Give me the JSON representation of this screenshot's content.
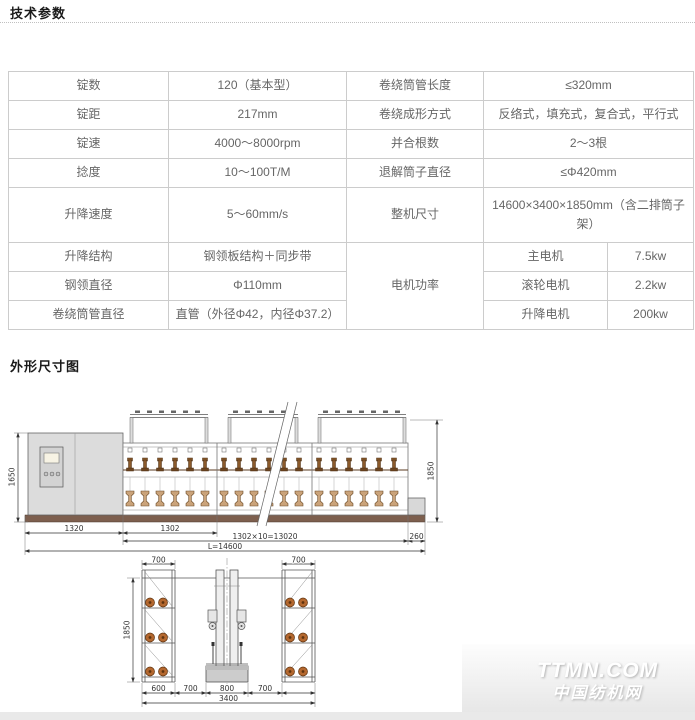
{
  "header": {
    "section1_title": "技术参数",
    "section2_title": "外形尺寸图"
  },
  "specs_table": {
    "rows": [
      {
        "l_label": "锭数",
        "l_value": "120（基本型）",
        "r_label": "卷绕筒管长度",
        "r_value": "≤320mm"
      },
      {
        "l_label": "锭距",
        "l_value": "217mm",
        "r_label": "卷绕成形方式",
        "r_value": "反络式，填充式，复合式，平行式"
      },
      {
        "l_label": "锭速",
        "l_value": "4000～8000rpm",
        "r_label": "并合根数",
        "r_value": "2～3根"
      },
      {
        "l_label": "捻度",
        "l_value": "10～100T/M",
        "r_label": "退解筒子直径",
        "r_value": "≤Φ420mm"
      },
      {
        "l_label": "升降速度",
        "l_value": "5～60mm/s",
        "r_label": "整机尺寸",
        "r_value": "14600×3400×1850mm（含二排筒子架）"
      }
    ],
    "motor_group_label": "电机功率",
    "motor_rows": [
      {
        "l_label": "升降结构",
        "l_value": "钢领板结构＋同步带",
        "m_label": "主电机",
        "m_value": "7.5kw"
      },
      {
        "l_label": "钢领直径",
        "l_value": "Φ110mm",
        "m_label": "滚轮电机",
        "m_value": "2.2kw"
      },
      {
        "l_label": "卷绕筒管直径",
        "l_value": "直管（外径Φ42，内径Φ37.2）",
        "m_label": "升降电机",
        "m_value": "200kw"
      }
    ]
  },
  "side_view": {
    "height_left": "1650",
    "height_right": "1850",
    "dim_cabinet": "1320",
    "dim_section": "1302",
    "dim_sections_total": "1302×10=13020",
    "dim_end": "260",
    "dim_total": "L=14600"
  },
  "end_view": {
    "dim_top_left": "700",
    "dim_top_right": "700",
    "height_left": "1850",
    "dim_b1": "600",
    "dim_b2": "700",
    "dim_b3": "800",
    "dim_b4": "700",
    "dim_total": "3400"
  },
  "watermark": {
    "line1": "TTMN.COM",
    "line2": "中国纺机网"
  }
}
